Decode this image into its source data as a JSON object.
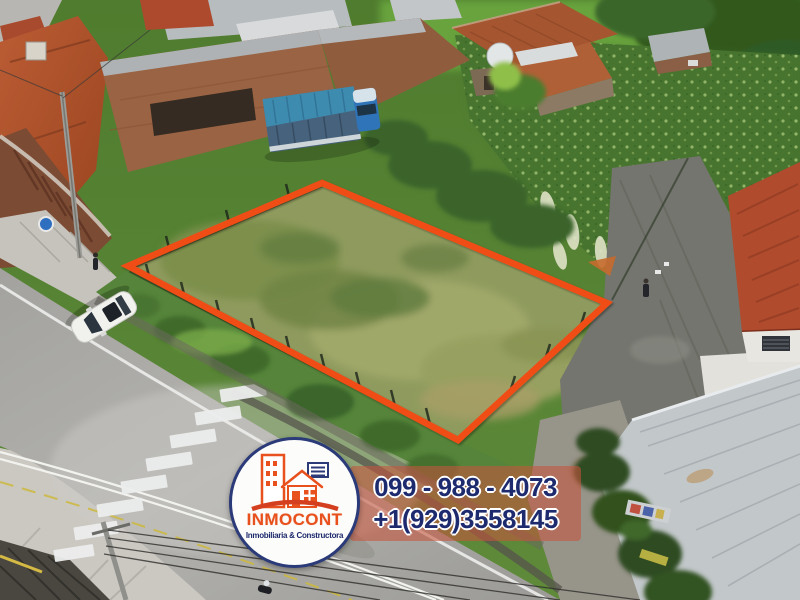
{
  "brand": {
    "name": "INMOCONT",
    "tagline": "Inmobiliaria & Constructora",
    "phone_local": "099 - 988 - 4073",
    "phone_intl": "+1(929)3558145",
    "colors": {
      "accent_orange": "#e8511d",
      "navy": "#1d2a6e",
      "banner_red": "#c65640",
      "boundary_orange": "#f04d15"
    },
    "icons": {
      "logo": "buildings-house-icon"
    }
  }
}
